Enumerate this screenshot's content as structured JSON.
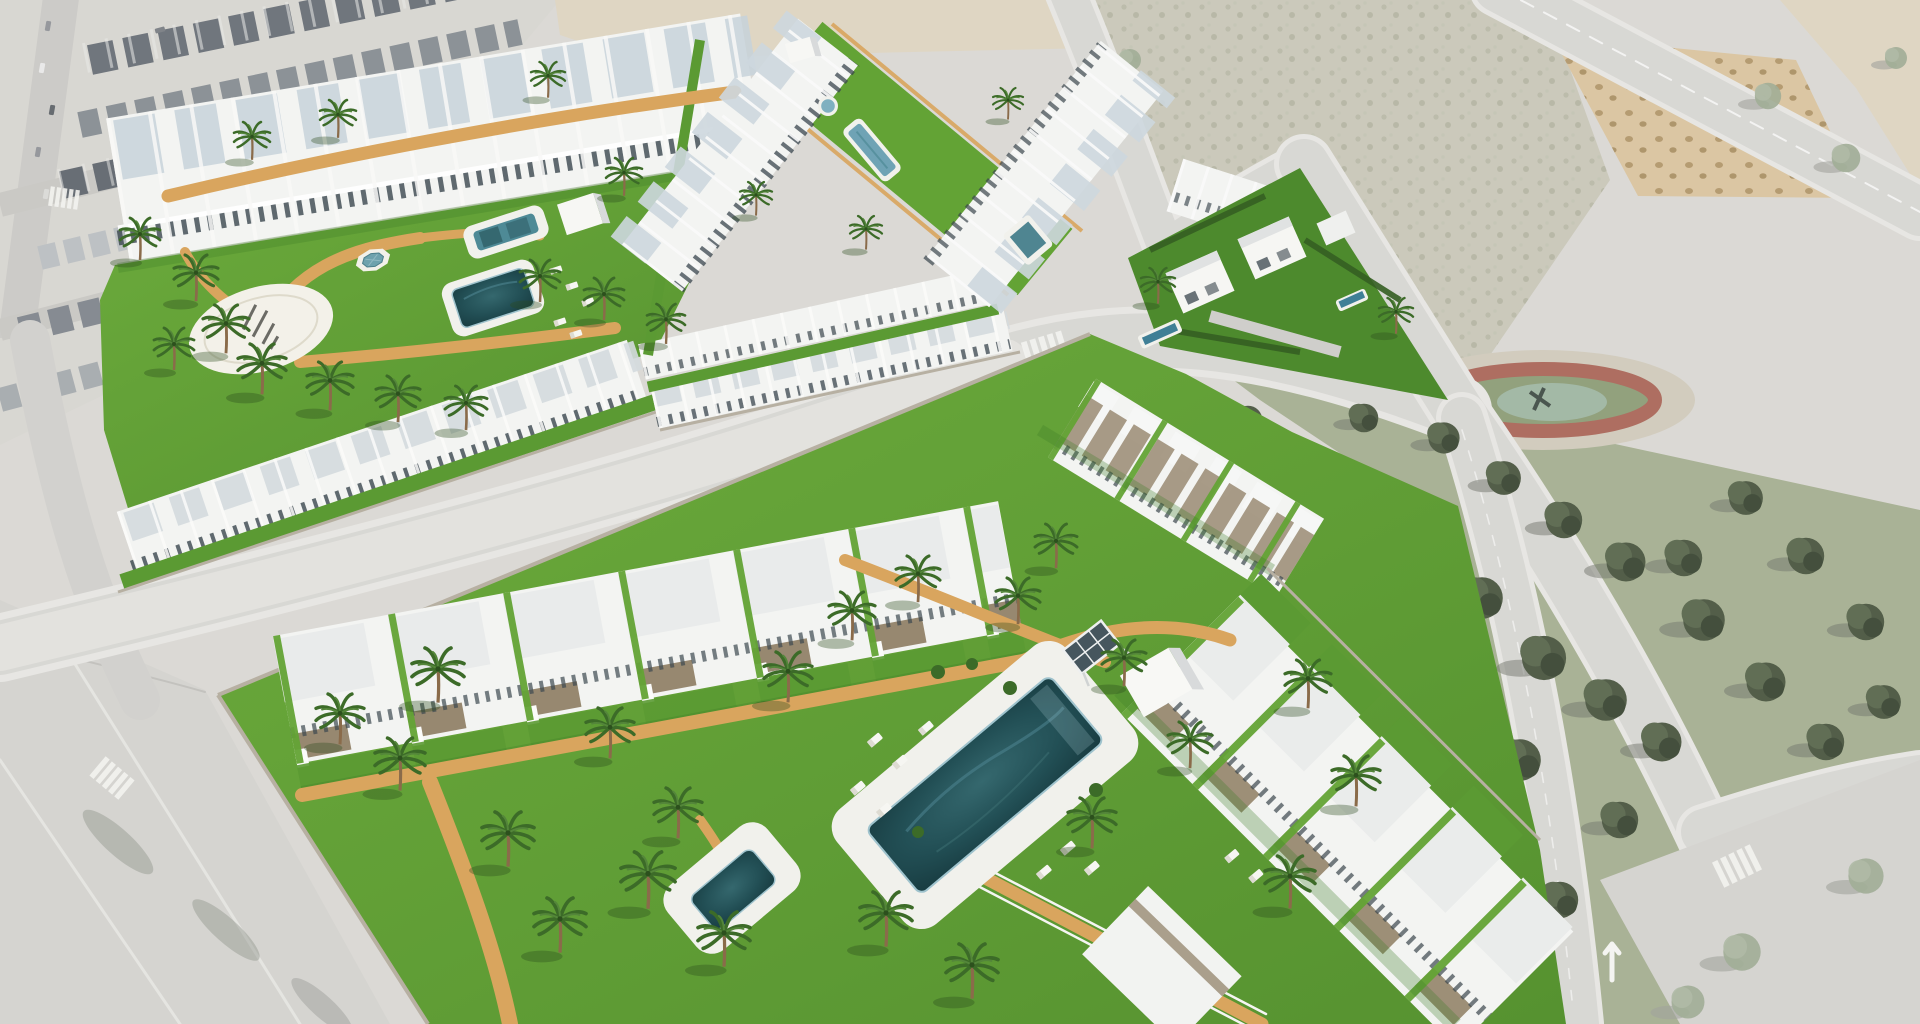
{
  "meta": {
    "image_type": "aerial 3D architectural visualization composited over a desaturated drone photo",
    "description": "New-build Mediterranean residential development: white apartment/bungalow blocks around bright green communal gardens with pools, palm trees and orange sand paths; surrounded by a faded existing town, vacant scrub plots, streets and a pine park with a red circular playground track.",
    "visible_text": []
  },
  "palette": {
    "photo_ground": "#d9d7d2",
    "photo_block": "#d6d4cf",
    "photo_road": "#d6d5d1",
    "photo_sidewalk": "#e6e5e1",
    "roof_dark": "#666c74",
    "roof_mid": "#9ba0a5",
    "scrub": "#c7c5b6",
    "scrub_dot": "#a9ab97",
    "sand": "#ddd3bf",
    "orchard_sand": "#d9c29c",
    "orchard_tree": "#a98d5f",
    "park_green": "#a3ad8e",
    "park_tree": "#46523c",
    "track_red": "#a86355",
    "track_apron": "#cfc9ba",
    "lawn": "#63a335",
    "lawn_shade": "#3f7d27",
    "villa_lawn": "#4d8a2d",
    "path_orange": "#d9a55e",
    "wall_white": "#f3f4f2",
    "wall_shade": "#d8dadb",
    "stone_wall": "#b7b0a2",
    "window_dark": "#3a464d",
    "pergola_brown": "#8d7c62",
    "pool_dark": "#224f55",
    "pool_mid": "#4e8a96",
    "pool_light": "#9fc3cd",
    "deck_white": "#f1f1ec",
    "plaza_white": "#f3f1e9",
    "palm_green": "#3c6b28",
    "palm_trunk": "#8a6b4a"
  },
  "scene": {
    "background": {
      "town": "existing low-rise town with gray gabled roofs, narrow streets and parked cars (top left, desaturated)",
      "vacant_plots": "scrubby unbuilt plots and a sandy orchard grid of trees (top right)",
      "park": "dense mature pine park with a red circular playground track and tan apron (right)",
      "roads": "light asphalt streets with zebra crossings, lane dashes and a painted turn arrow (bottom right and bottom left)"
    },
    "development": {
      "complex_a": {
        "label": "north-west community",
        "features": [
          "long rows of white two-storey townhouses",
          "communal lawn",
          "two rectangular pools with white decks",
          "octagonal ornamental fountain",
          "white circular plaza with dark ground logo",
          "white pavilion cube",
          "orange sand paths",
          "palm trees",
          "sun loungers"
        ]
      },
      "complex_b": {
        "label": "north bungalow rows",
        "features": [
          "two facing rows of white bungalows",
          "long central lawn strip",
          "round splash pool",
          "lap pool",
          "square pool",
          "white storage cube"
        ]
      },
      "villas": {
        "label": "detached two-storey villas",
        "features": [
          "flat-roofed white villas",
          "dark hedged gardens",
          "small private pools"
        ]
      },
      "complex_c": {
        "label": "large south community",
        "features": [
          "large white apartment blocks with timber pergolas and stair towers",
          "huge lawn courtyard",
          "big dark lagoon pool with white deck",
          "secondary plunge pool",
          "white pavilion cube",
          "tilted solar pergola",
          "orange walkways and perimeter wall path",
          "many palm trees",
          "sun loungers"
        ]
      }
    },
    "counts": {
      "communal_pools": 7,
      "villa_pools": 2,
      "ornamental_fountain": 1,
      "circular_plaza": 1,
      "palm_trees_approx": 40,
      "sun_loungers_approx": 18
    }
  }
}
